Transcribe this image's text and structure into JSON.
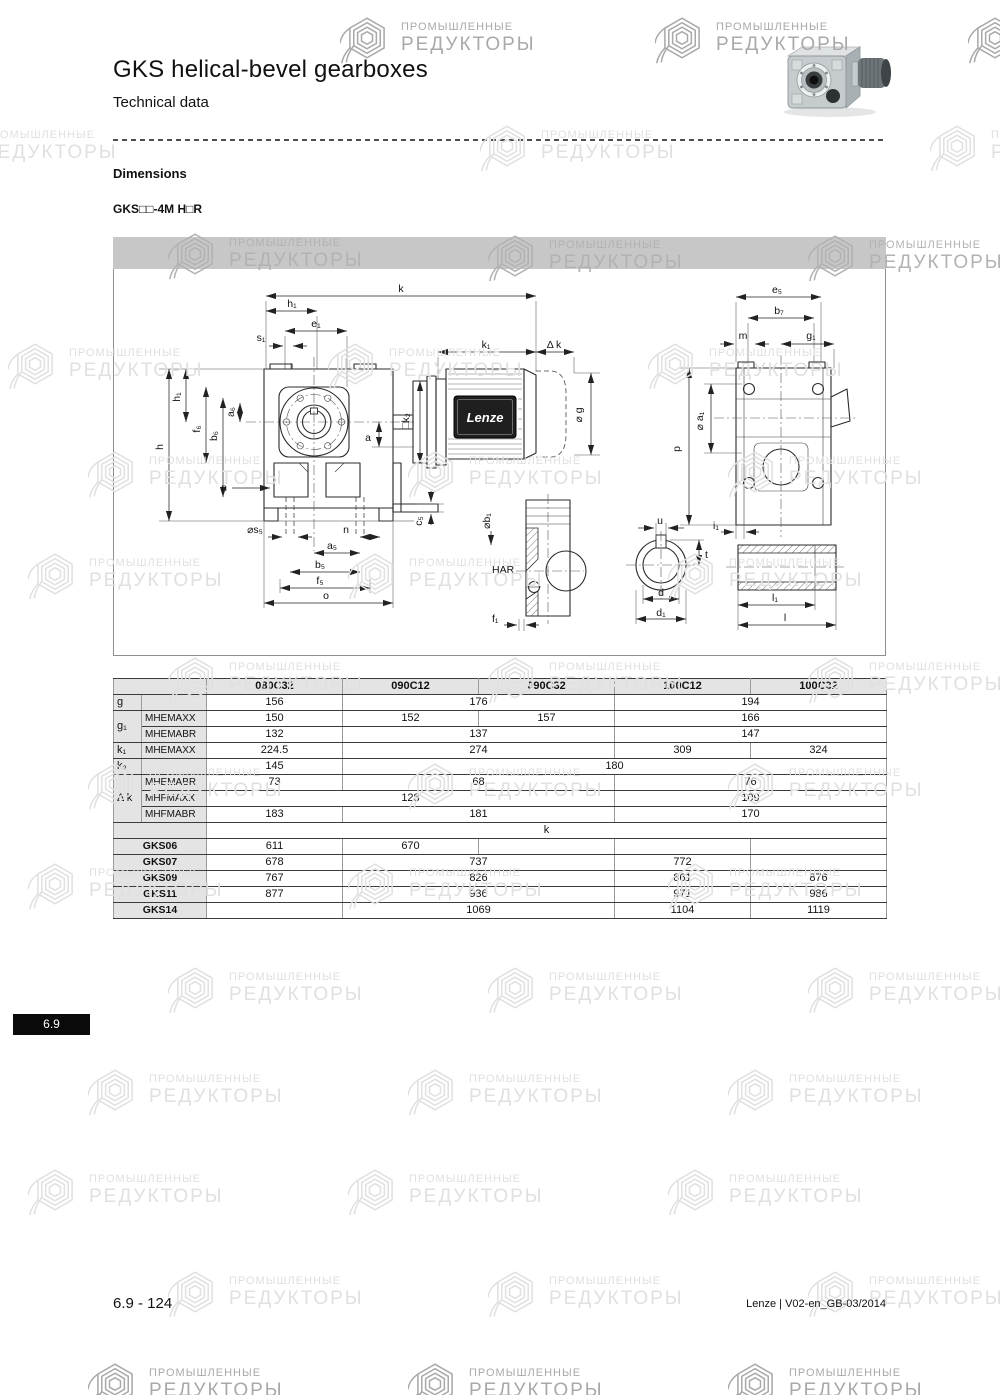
{
  "header": {
    "title": "GKS helical-bevel gearboxes",
    "subtitle": "Technical data"
  },
  "section": {
    "heading": "Dimensions",
    "model": "GKS□□-4M H□R"
  },
  "watermark": {
    "line1": "ПРОМЫШЛЕННЫЕ",
    "line2": "РЕДУКТОРЫ"
  },
  "drawing": {
    "labels": {
      "k": "k",
      "k1": "k₁",
      "dk": "Δ k",
      "h1": "h₁",
      "e1": "e₁",
      "s1": "s₁",
      "h": "h",
      "f6": "f₆",
      "b6": "b₆",
      "a6": "a₆",
      "n": "n",
      "s5": "⌀s₅",
      "a5": "a₅",
      "b5": "b₅",
      "f5": "f₅",
      "o": "o",
      "c5": "c₅",
      "a": "a",
      "k2sq": "□k₂",
      "g": "⌀ g",
      "e5": "e₅",
      "b7": "b₇",
      "m": "m",
      "g1": "g₁",
      "p": "p",
      "a1": "⌀ a₁",
      "i1": "i₁",
      "b1": "⌀b₁",
      "f1": "f₁",
      "har": "HAR",
      "u": "u",
      "t": "t",
      "d": "d",
      "d1": "d₁",
      "l1": "l₁",
      "l": "l",
      "brand": "Lenze"
    }
  },
  "table": {
    "col_headers": [
      "080C32",
      "090C12",
      "090C32",
      "100C12",
      "100C32"
    ],
    "row_labels": {
      "g": "g",
      "g1": "g₁",
      "k1": "k₁",
      "k2": "k₂",
      "dk": "Δ k"
    },
    "sub_labels": {
      "mhemaxx": "MHEMAXX",
      "mhemabr": "MHEMABR",
      "mhfmaxx": "MHFMAXX",
      "mhfmabr": "MHFMABR"
    },
    "k_section": "k",
    "values": {
      "g": [
        "156",
        "176",
        "194"
      ],
      "g1_mhemaxx": [
        "150",
        "152",
        "157",
        "166"
      ],
      "g1_mhemabr": [
        "132",
        "137",
        "147"
      ],
      "k1_mhemaxx": [
        "224.5",
        "274",
        "309",
        "324"
      ],
      "k2": [
        "145",
        "180"
      ],
      "dk_mhemabr": [
        "73",
        "68",
        "76"
      ],
      "dk_mhfmaxx": [
        "128",
        "109"
      ],
      "dk_mhfmabr": [
        "183",
        "181",
        "170"
      ]
    },
    "gks_rows": [
      {
        "label": "GKS06",
        "cells": [
          "611",
          "670",
          "",
          "",
          ""
        ]
      },
      {
        "label": "GKS07",
        "cells": [
          "678",
          "737",
          "772",
          ""
        ]
      },
      {
        "label": "GKS09",
        "cells": [
          "767",
          "826",
          "861",
          "876"
        ]
      },
      {
        "label": "GKS11",
        "cells": [
          "877",
          "936",
          "971",
          "986"
        ]
      },
      {
        "label": "GKS14",
        "cells": [
          "",
          "1069",
          "1104",
          "1119"
        ]
      }
    ]
  },
  "badge": {
    "label": "6.9"
  },
  "footer": {
    "page": "6.9 - 124",
    "doc": "Lenze | V02-en_GB-03/2014"
  }
}
